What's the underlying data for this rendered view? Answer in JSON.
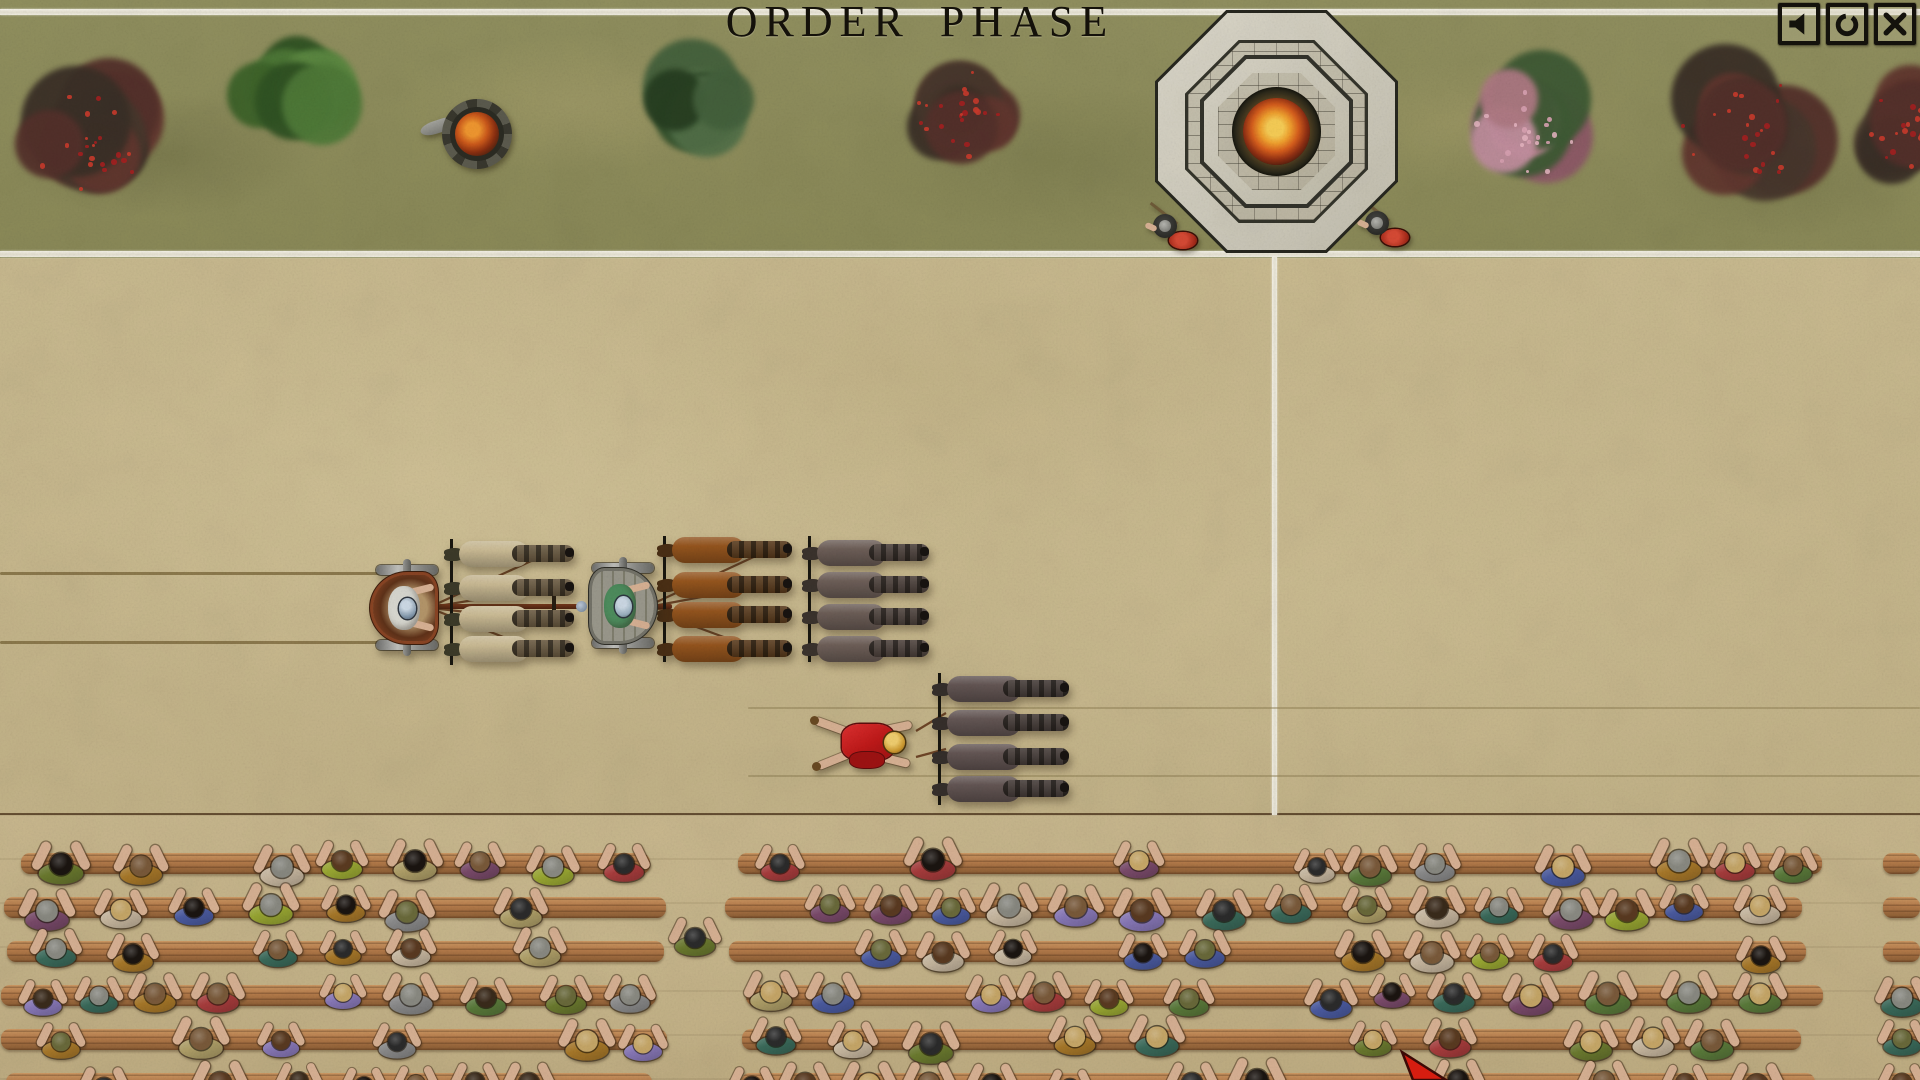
{
  "hud": {
    "phase_title": "ORDER PHASE",
    "buttons": [
      {
        "id": "mute-button",
        "icon": "speaker-icon"
      },
      {
        "id": "options-button",
        "icon": "circle-icon"
      },
      {
        "id": "close-button",
        "icon": "close-icon"
      }
    ]
  },
  "colors": {
    "grass": "#8f8d5c",
    "sand": "#c9b98e",
    "boundary_line": "#f3f0e5",
    "stand_dirt": "#c6b58c",
    "bench_wood": "#b57b4a",
    "bench_wood_dark": "#8a5c33",
    "stand_edge": "#42321f",
    "fire_core": "#f6bd45",
    "shield_red": "#b33020",
    "rein": "#6e4526",
    "cursor_red": "#d61d10",
    "icon_ink": "#14120c"
  },
  "scene": {
    "tree_palettes": {
      "red-berry": {
        "lobes": [
          "#54302a",
          "#47372c",
          "#61362e",
          "#3a2f26"
        ],
        "dots": [
          "#a61f1f",
          "#cc3b2b"
        ]
      },
      "green-bright": {
        "lobes": [
          "#4f7a38",
          "#3d6329",
          "#5d8a42",
          "#2f5222"
        ],
        "dots": []
      },
      "green-dark": {
        "lobes": [
          "#44613c",
          "#33512c",
          "#527048",
          "#263e20"
        ],
        "dots": []
      },
      "pink-blossom": {
        "lobes": [
          "#b07a84",
          "#8f5a68",
          "#3e5a34",
          "#c490a0"
        ],
        "dots": [
          "#d9a2b2",
          "#e4b4c0"
        ]
      }
    },
    "trees": [
      {
        "type": "red-berry",
        "cx": 95,
        "cy": 140,
        "r": 92
      },
      {
        "type": "green-bright",
        "cx": 292,
        "cy": 97,
        "r": 66
      },
      {
        "type": "green-dark",
        "cx": 703,
        "cy": 103,
        "r": 77
      },
      {
        "type": "red-berry",
        "cx": 962,
        "cy": 110,
        "r": 72
      },
      {
        "type": "pink-blossom",
        "cx": 1523,
        "cy": 128,
        "r": 78
      },
      {
        "type": "red-berry",
        "cx": 1742,
        "cy": 126,
        "r": 92
      },
      {
        "type": "red-berry",
        "cx": 1908,
        "cy": 130,
        "r": 70
      }
    ],
    "brazier": {
      "cx": 477,
      "cy": 134,
      "r": 35
    },
    "altar": {
      "cx": 1277,
      "cy": 132,
      "size": 243
    },
    "soldiers": [
      {
        "x": 1170,
        "y": 228
      },
      {
        "x": 1382,
        "y": 225
      }
    ],
    "chariots": [
      {
        "id": "white-chariot",
        "x": 372,
        "y": 562,
        "body": "#8a4423",
        "inner": "#5e3118",
        "floor": "#b5966a",
        "driver": "#dadad2",
        "helmet": "#7d93a8"
      },
      {
        "id": "green-chariot",
        "x": 588,
        "y": 560,
        "body": "#8e8d85",
        "inner": "#7b796b",
        "floor": "#93917f",
        "driver": "#4e8e5e",
        "helmet": "#9ab0c0"
      }
    ],
    "horse_teams": [
      {
        "id": "white-team",
        "x": 450,
        "y": 541,
        "len": 135,
        "pitch": 32,
        "body": "#cdbd96",
        "head": "#6b5a40",
        "tail": "#3c3a28"
      },
      {
        "id": "green-team",
        "x": 663,
        "y": 538,
        "len": 140,
        "pitch": 32,
        "body": "#96551d",
        "head": "#5a3a1a",
        "tail": "#4a2e14"
      },
      {
        "id": "loose-team-upper",
        "x": 808,
        "y": 538,
        "len": 132,
        "pitch": 32,
        "body": "#6e5f58",
        "head": "#4e423c",
        "tail": "#3a322c"
      },
      {
        "id": "loose-team-lower",
        "x": 938,
        "y": 675,
        "len": 142,
        "pitch": 34,
        "body": "#645654",
        "head": "#463c38",
        "tail": "#352e2a"
      }
    ],
    "poles": [
      {
        "x": 438,
        "y": 604,
        "len": 144,
        "crossbar_x": 552,
        "knob": true
      },
      {
        "x": 648,
        "y": 604,
        "len": 24,
        "crossbar_x": 0,
        "knob": false
      }
    ],
    "reins": [
      {
        "x1": 432,
        "y1": 606,
        "x2": 540,
        "y2": 557
      },
      {
        "x1": 432,
        "y1": 607,
        "x2": 540,
        "y2": 589
      },
      {
        "x1": 432,
        "y1": 608,
        "x2": 542,
        "y2": 621
      },
      {
        "x1": 432,
        "y1": 609,
        "x2": 544,
        "y2": 653
      },
      {
        "x1": 648,
        "y1": 606,
        "x2": 760,
        "y2": 554
      },
      {
        "x1": 648,
        "y1": 607,
        "x2": 760,
        "y2": 586
      },
      {
        "x1": 648,
        "y1": 608,
        "x2": 762,
        "y2": 618
      },
      {
        "x1": 648,
        "y1": 609,
        "x2": 764,
        "y2": 652
      },
      {
        "x1": 916,
        "y1": 731,
        "x2": 946,
        "y2": 713
      },
      {
        "x1": 916,
        "y1": 757,
        "x2": 946,
        "y2": 749
      }
    ],
    "wheel_ruts": [
      {
        "x": 0,
        "y": 572,
        "len": 432,
        "strong": true
      },
      {
        "x": 0,
        "y": 641,
        "len": 432,
        "strong": true
      },
      {
        "x": 748,
        "y": 707,
        "len": 1172,
        "strong": false
      },
      {
        "x": 748,
        "y": 775,
        "len": 1172,
        "strong": false
      }
    ],
    "fallen_charioteer": {
      "x": 812,
      "y": 712,
      "tunic": "#c01818",
      "tunic_dark": "#a01212",
      "helmet": "#cf9a2e",
      "skin": "#d9b294"
    },
    "cursor": {
      "x": 1396,
      "y": 1048
    }
  },
  "stands": {
    "edge_y": 815,
    "sections": [
      {
        "x": 0,
        "w": 670
      },
      {
        "x": 723,
        "w": 1102
      },
      {
        "x": 1883,
        "w": 37
      }
    ],
    "plank_rows_y": [
      853,
      897,
      941,
      985,
      1029,
      1073
    ],
    "plank_height": 21,
    "crowd_rows_y": [
      842,
      886,
      930,
      974,
      1018,
      1062
    ],
    "aisle_spectators": [
      {
        "x": 672,
        "y": 916
      }
    ],
    "seed": 20240117,
    "density": 0.75,
    "tunic_colors": [
      "#6b7a2e",
      "#9aa832",
      "#4a5aa0",
      "#8878b8",
      "#a83c3c",
      "#b0a068",
      "#5a7a3a",
      "#a87828",
      "#8a8a8a",
      "#3a6a5a",
      "#7a4a6a",
      "#c8b8a0"
    ],
    "hair_colors": [
      "#1a1410",
      "#3a2a1a",
      "#5a3a20",
      "#8a8a82",
      "#c8a868",
      "#6a6a3a",
      "#2a2a2a",
      "#7a5a3a"
    ],
    "skin": "#d9b294"
  }
}
